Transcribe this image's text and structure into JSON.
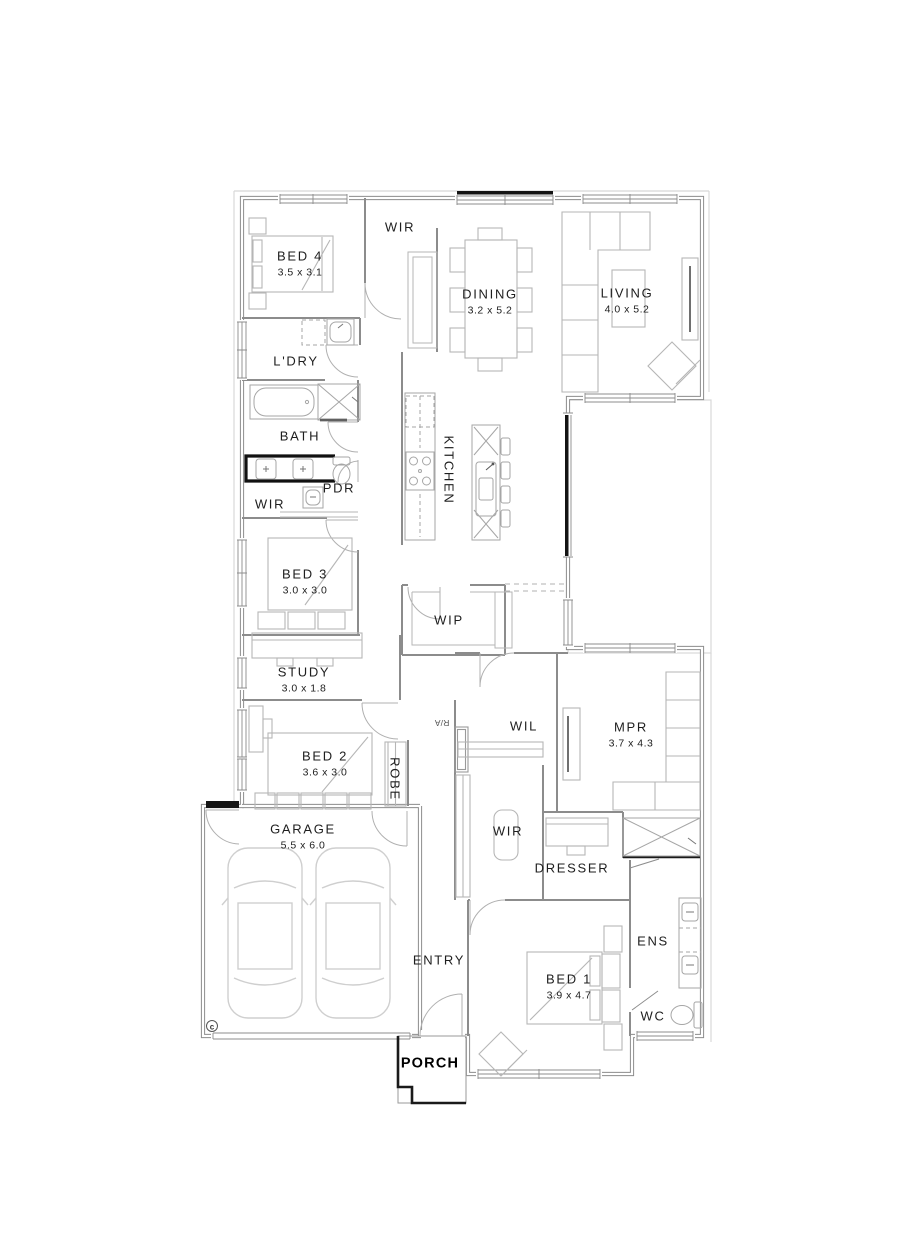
{
  "plan": {
    "copyright_mark": "c",
    "rooms": [
      {
        "id": "bed4",
        "label": "BED 4",
        "dims": "3.5 x 3.1",
        "x": 300,
        "y": 264,
        "rot": 0
      },
      {
        "id": "wir-bed4",
        "label": "WIR",
        "x": 400,
        "y": 228,
        "rot": 0
      },
      {
        "id": "dining",
        "label": "DINING",
        "dims": "3.2 x 5.2",
        "x": 490,
        "y": 302,
        "rot": 0
      },
      {
        "id": "living",
        "label": "LIVING",
        "dims": "4.0 x 5.2",
        "x": 627,
        "y": 301,
        "rot": 0
      },
      {
        "id": "ldry",
        "label": "L'DRY",
        "x": 296,
        "y": 362,
        "rot": 0
      },
      {
        "id": "bath",
        "label": "BATH",
        "x": 300,
        "y": 437,
        "rot": 0
      },
      {
        "id": "pdr",
        "label": "PDR",
        "x": 339,
        "y": 489,
        "rot": 0
      },
      {
        "id": "wir-hall",
        "label": "WIR",
        "x": 270,
        "y": 505,
        "rot": 0
      },
      {
        "id": "kitchen",
        "label": "KITCHEN",
        "x": 448,
        "y": 470,
        "rot": 90
      },
      {
        "id": "bed3",
        "label": "BED 3",
        "dims": "3.0 x 3.0",
        "x": 305,
        "y": 582,
        "rot": 0
      },
      {
        "id": "wip",
        "label": "WIP",
        "x": 449,
        "y": 621,
        "rot": 0
      },
      {
        "id": "study",
        "label": "STUDY",
        "dims": "3.0 x 1.8",
        "x": 304,
        "y": 680,
        "rot": 0
      },
      {
        "id": "ra",
        "label": "R/A",
        "x": 442,
        "y": 722,
        "rot": 180,
        "small": true
      },
      {
        "id": "wil",
        "label": "WIL",
        "x": 524,
        "y": 727,
        "rot": 0
      },
      {
        "id": "mpr",
        "label": "MPR",
        "dims": "3.7 x 4.3",
        "x": 631,
        "y": 735,
        "rot": 0
      },
      {
        "id": "bed2",
        "label": "BED 2",
        "dims": "3.6 x 3.0",
        "x": 325,
        "y": 764,
        "rot": 0
      },
      {
        "id": "robe",
        "label": "ROBE",
        "x": 394,
        "y": 779,
        "rot": 90
      },
      {
        "id": "garage",
        "label": "GARAGE",
        "dims": "5.5 x 6.0",
        "x": 303,
        "y": 837,
        "rot": 0
      },
      {
        "id": "wir-master",
        "label": "WIR",
        "x": 508,
        "y": 832,
        "rot": 0
      },
      {
        "id": "dresser",
        "label": "DRESSER",
        "x": 572,
        "y": 869,
        "rot": 0
      },
      {
        "id": "entry",
        "label": "ENTRY",
        "x": 439,
        "y": 961,
        "rot": 0
      },
      {
        "id": "ens",
        "label": "ENS",
        "x": 653,
        "y": 942,
        "rot": 0
      },
      {
        "id": "bed1",
        "label": "BED 1",
        "dims": "3.9 x 4.7",
        "x": 569,
        "y": 987,
        "rot": 0
      },
      {
        "id": "wc",
        "label": "WC",
        "x": 653,
        "y": 1017,
        "rot": 0
      },
      {
        "id": "porch",
        "label": "PORCH",
        "x": 430,
        "y": 1064,
        "rot": 0,
        "bold": true
      }
    ]
  }
}
